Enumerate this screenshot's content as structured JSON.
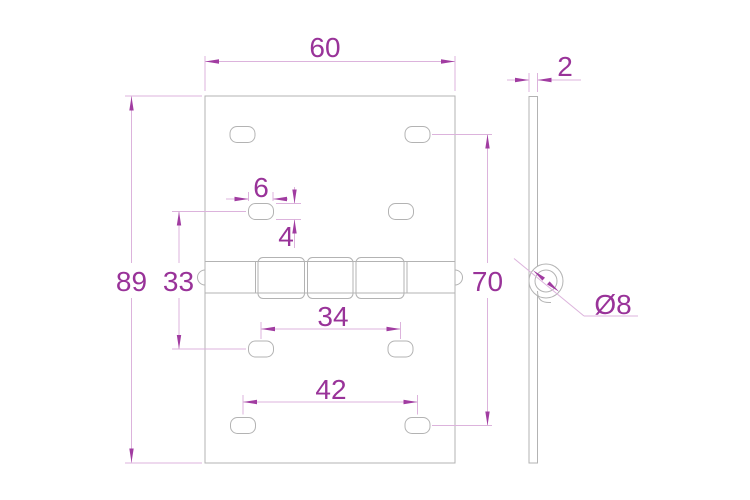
{
  "drawing": {
    "kind": "hinge-technical-drawing",
    "views": [
      "front",
      "side"
    ]
  },
  "dimensions": {
    "plate_width": "60",
    "plate_height": "89",
    "leaf_thickness": "2",
    "outer_hole_rows_span": "70",
    "inner_hole_rows_span": "33",
    "slot_width": "6",
    "slot_height": "4",
    "middle_holes_spacing": "34",
    "bottom_holes_spacing": "42",
    "knuckle_diameter": "Ø8"
  },
  "colors": {
    "dimension_text": "#993399",
    "dimension_line": "#dcb3dc",
    "geometry_line": "#b3b3b3",
    "background": "#ffffff"
  }
}
